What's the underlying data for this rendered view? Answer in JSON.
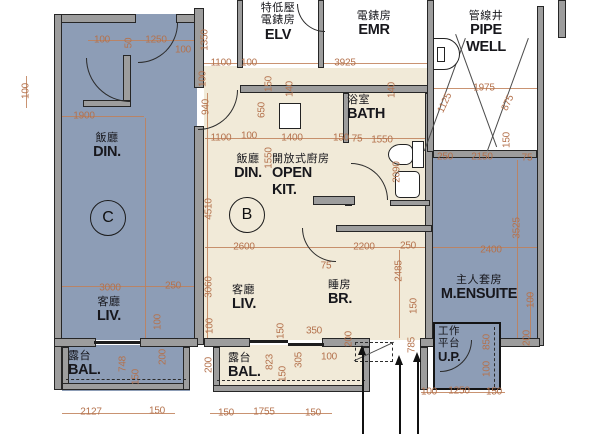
{
  "colors": {
    "unit_blue": "#8d9db6",
    "unit_cream": "#f1ead8",
    "wall_gray": "#9d9d9d",
    "dim": "#b4724d",
    "dim_line": "#c08059"
  },
  "badges": {
    "unit_c": "C",
    "unit_b": "B"
  },
  "rooms": {
    "elv": {
      "zh1": "特低壓",
      "zh2": "電錶房",
      "en": "ELV"
    },
    "emr": {
      "zh": "電錶房",
      "en": "EMR"
    },
    "pipe_well": {
      "zh": "管線井",
      "en1": "PIPE",
      "en2": "WELL"
    },
    "din_c": {
      "zh": "飯廳",
      "en": "DIN."
    },
    "liv_c": {
      "zh": "客廳",
      "en": "LIV."
    },
    "bal_c": {
      "zh": "露台",
      "en": "BAL."
    },
    "din_b": {
      "zh": "飯廳",
      "en": "DIN."
    },
    "open_kit": {
      "zh": "開放式廚房",
      "en1": "OPEN",
      "en2": "KIT."
    },
    "bath": {
      "zh": "浴室",
      "en": "BATH"
    },
    "br": {
      "zh": "睡房",
      "en": "BR."
    },
    "liv_b": {
      "zh": "客廳",
      "en": "LIV."
    },
    "bal_b": {
      "zh": "露台",
      "en": "BAL."
    },
    "m_ensuite": {
      "zh": "主人套房",
      "en": "M.ENSUITE"
    },
    "up": {
      "zh1": "工作",
      "zh2": "平台",
      "en": "U.P."
    }
  },
  "dimensions": [
    {
      "t": "100",
      "x": 102,
      "y": 40
    },
    {
      "t": "50",
      "x": 129,
      "y": 43,
      "r": -90
    },
    {
      "t": "1250",
      "x": 156,
      "y": 40
    },
    {
      "t": "100",
      "x": 183,
      "y": 50
    },
    {
      "t": "100",
      "x": 26,
      "y": 91,
      "r": -90
    },
    {
      "t": "1900",
      "x": 84,
      "y": 116
    },
    {
      "t": "1350",
      "x": 205,
      "y": 40,
      "r": -90
    },
    {
      "t": "1100",
      "x": 221,
      "y": 63
    },
    {
      "t": "100",
      "x": 249,
      "y": 63
    },
    {
      "t": "3925",
      "x": 345,
      "y": 63
    },
    {
      "t": "100",
      "x": 203,
      "y": 79,
      "r": -90
    },
    {
      "t": "940",
      "x": 206,
      "y": 107,
      "r": -90
    },
    {
      "t": "150",
      "x": 269,
      "y": 84,
      "r": -90
    },
    {
      "t": "140",
      "x": 290,
      "y": 89,
      "r": -90
    },
    {
      "t": "650",
      "x": 262,
      "y": 110,
      "r": -90
    },
    {
      "t": "140",
      "x": 392,
      "y": 90,
      "r": -90
    },
    {
      "t": "1975",
      "x": 484,
      "y": 88
    },
    {
      "t": "1125",
      "x": 445,
      "y": 103,
      "r": -65
    },
    {
      "t": "875",
      "x": 508,
      "y": 103,
      "r": -65
    },
    {
      "t": "1100",
      "x": 221,
      "y": 138
    },
    {
      "t": "100",
      "x": 249,
      "y": 136
    },
    {
      "t": "1400",
      "x": 292,
      "y": 138
    },
    {
      "t": "150",
      "x": 341,
      "y": 138
    },
    {
      "t": "75",
      "x": 357,
      "y": 139
    },
    {
      "t": "1550",
      "x": 382,
      "y": 140
    },
    {
      "t": "1550",
      "x": 269,
      "y": 158,
      "r": -90
    },
    {
      "t": "2090",
      "x": 397,
      "y": 172,
      "r": -90
    },
    {
      "t": "150",
      "x": 507,
      "y": 140,
      "r": -90
    },
    {
      "t": "250",
      "x": 445,
      "y": 157
    },
    {
      "t": "2150",
      "x": 482,
      "y": 157
    },
    {
      "t": "75",
      "x": 527,
      "y": 158
    },
    {
      "t": "4510",
      "x": 209,
      "y": 209,
      "r": -90
    },
    {
      "t": "2600",
      "x": 244,
      "y": 247
    },
    {
      "t": "2200",
      "x": 364,
      "y": 247
    },
    {
      "t": "250",
      "x": 408,
      "y": 246
    },
    {
      "t": "2400",
      "x": 491,
      "y": 250
    },
    {
      "t": "3525",
      "x": 517,
      "y": 228,
      "r": -90
    },
    {
      "t": "75",
      "x": 326,
      "y": 266
    },
    {
      "t": "2485",
      "x": 399,
      "y": 271,
      "r": -90
    },
    {
      "t": "3060",
      "x": 209,
      "y": 287,
      "r": -90
    },
    {
      "t": "3000",
      "x": 110,
      "y": 288
    },
    {
      "t": "250",
      "x": 173,
      "y": 286
    },
    {
      "t": "100",
      "x": 158,
      "y": 322,
      "r": -90
    },
    {
      "t": "150",
      "x": 414,
      "y": 306,
      "r": -90
    },
    {
      "t": "100",
      "x": 531,
      "y": 300,
      "r": -90
    },
    {
      "t": "100",
      "x": 210,
      "y": 326,
      "r": -90
    },
    {
      "t": "150",
      "x": 281,
      "y": 331,
      "r": -90
    },
    {
      "t": "350",
      "x": 314,
      "y": 331
    },
    {
      "t": "200",
      "x": 349,
      "y": 339,
      "r": -90
    },
    {
      "t": "785",
      "x": 412,
      "y": 345,
      "r": -90
    },
    {
      "t": "200",
      "x": 163,
      "y": 357,
      "r": -90
    },
    {
      "t": "748",
      "x": 123,
      "y": 364,
      "r": -90
    },
    {
      "t": "150",
      "x": 136,
      "y": 377,
      "r": -90
    },
    {
      "t": "200",
      "x": 209,
      "y": 365,
      "r": -90
    },
    {
      "t": "823",
      "x": 270,
      "y": 362,
      "r": -90
    },
    {
      "t": "305",
      "x": 299,
      "y": 360,
      "r": -90
    },
    {
      "t": "150",
      "x": 283,
      "y": 374,
      "r": -90
    },
    {
      "t": "100",
      "x": 329,
      "y": 357
    },
    {
      "t": "200",
      "x": 527,
      "y": 338,
      "r": -90
    },
    {
      "t": "850",
      "x": 487,
      "y": 342,
      "r": -90
    },
    {
      "t": "100",
      "x": 487,
      "y": 369,
      "r": -90
    },
    {
      "t": "100",
      "x": 429,
      "y": 392
    },
    {
      "t": "1250",
      "x": 459,
      "y": 391
    },
    {
      "t": "150",
      "x": 494,
      "y": 392
    },
    {
      "t": "2127",
      "x": 91,
      "y": 412
    },
    {
      "t": "150",
      "x": 157,
      "y": 411
    },
    {
      "t": "150",
      "x": 226,
      "y": 413
    },
    {
      "t": "1755",
      "x": 264,
      "y": 412
    },
    {
      "t": "150",
      "x": 313,
      "y": 413
    }
  ]
}
